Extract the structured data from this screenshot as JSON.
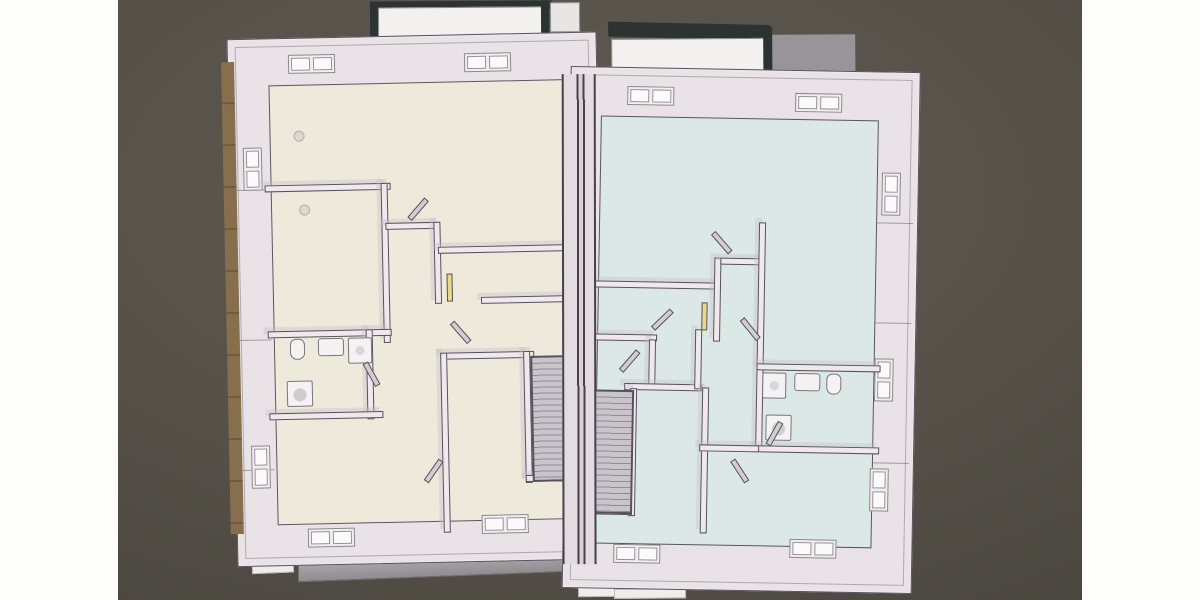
{
  "scene": {
    "description": "Top-down 3D CAD model of an upper floor with two mirrored apartment units shown side by side, photographed on a dark olive screen background with white margins left and right",
    "left_unit_label": "left unit (cream floor)",
    "right_unit_label": "right unit (pale blue floor)",
    "features": [
      "roof dormers at top",
      "central party wall",
      "mirrored staircases along party wall",
      "bathroom with toilet, sink, shower and washer in each unit",
      "window openings in exterior walls",
      "grey facade fascia below the units"
    ]
  },
  "colors": {
    "canvas_white": "#fdfdfc",
    "backdrop_olive": "#56524a",
    "backdrop_olive_dark": "#3d3a34",
    "wall_face": "#e9e3e7",
    "wall_line": "#55525c",
    "left_floor": "#edeadb",
    "right_floor": "#dce8e5",
    "brown_trim": "#876f4e",
    "stair_fill": "#c8c4ca",
    "stair_line": "#908c94",
    "dormer_dark": "#2c3433",
    "dormer_face": "#f2f1f0",
    "slab_gray": "#98959a",
    "fascia_light": "#c6c2c5",
    "fascia_dark": "#908d90",
    "fixture_fill": "#f4f2f3",
    "fixture_line": "#7a757c",
    "accent_yellow": "#e6d98c",
    "lamp_dot": "#dcd8d2"
  }
}
